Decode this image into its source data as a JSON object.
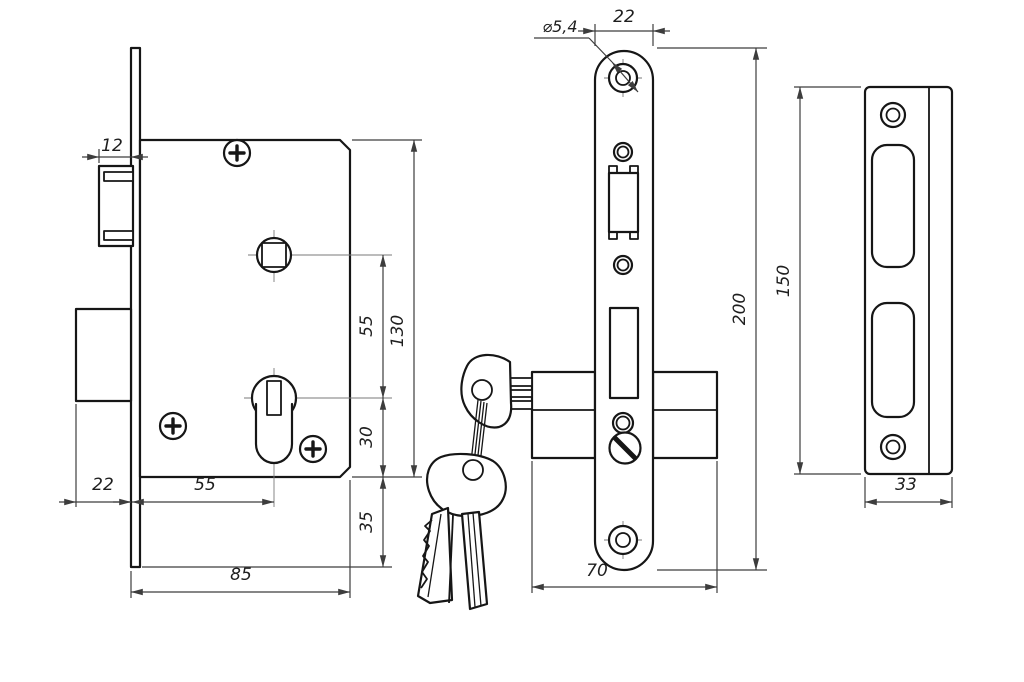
{
  "drawing": {
    "type": "technical-drawing",
    "subject": "mortise-lock-with-cylinder-keys-and-strike-plate",
    "background_color": "#ffffff",
    "line_color": "#161616",
    "dimension_line_color": "#3d3d3d"
  },
  "dims": {
    "left": {
      "latch_protrusion": "12",
      "deadbolt_throw": "22",
      "backset": "55",
      "body_width": "85",
      "center_distance": "55",
      "body_height": "130",
      "cylinder_to_bottom": "30",
      "faceplate_overhang": "35"
    },
    "front": {
      "hole_diameter": "⌀5,4",
      "plate_width": "22",
      "plate_height": "200",
      "cylinder_length": "70"
    },
    "strike": {
      "plate_height": "150",
      "plate_width": "33"
    }
  }
}
